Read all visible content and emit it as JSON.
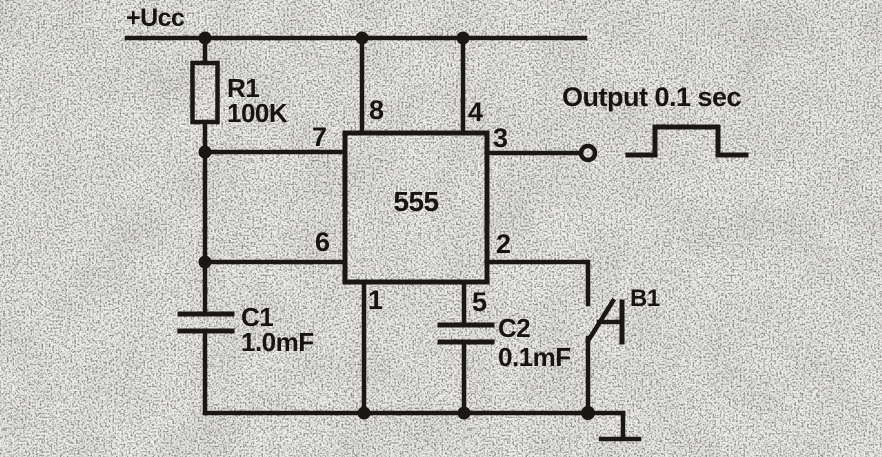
{
  "colors": {
    "ink": "#1b1813",
    "paper": "#f0efeb"
  },
  "power_rail": {
    "label": "+Ucc"
  },
  "resistor_r1": {
    "designator": "R1",
    "value": "100K"
  },
  "ic_555": {
    "label": "555",
    "pins": {
      "p1": "1",
      "p2": "2",
      "p3": "3",
      "p4": "4",
      "p5": "5",
      "p6": "6",
      "p7": "7",
      "p8": "8"
    }
  },
  "output": {
    "label": "Output 0.1 sec"
  },
  "capacitor_c1": {
    "designator": "C1",
    "value": "1.0mF"
  },
  "capacitor_c2": {
    "designator": "C2",
    "value": "0.1mF"
  },
  "button_b1": {
    "designator": "B1"
  }
}
